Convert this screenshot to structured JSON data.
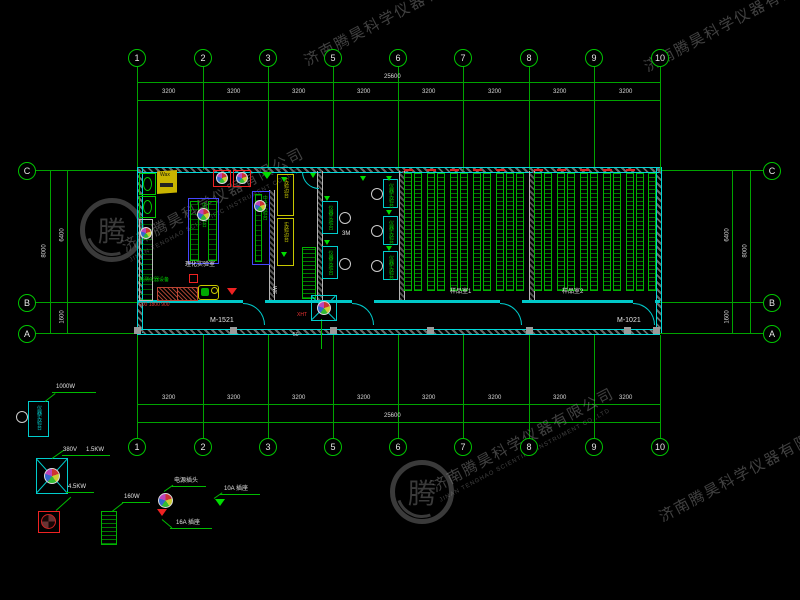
{
  "watermark": {
    "cn": "济南腾昊科学仪器有限公司",
    "en": "JINAN TENGHAO SCIENTIFIC INSTRUMENT CO.,LTD",
    "logo_char": "腾"
  },
  "grid": {
    "cols": [
      "1",
      "2",
      "3",
      "5",
      "6",
      "7",
      "8",
      "9",
      "10"
    ],
    "bay_dim": "3200",
    "total_dim": "25600",
    "rows": [
      "C",
      "B",
      "A"
    ],
    "row_dim_cb": "6400",
    "row_dim_ba": "1600",
    "row_dim_total": "8000"
  },
  "plan": {
    "door_left_label": "M-1521",
    "door_right_label": "M-1021",
    "room_lab_label": "理化实验室",
    "room_mid_label": "3M",
    "room_sample1_label": "样品室1",
    "room_sample2_label": "样品室2",
    "bench_center_text": "中央实验台",
    "bench_side_text": "实验边台",
    "bench_instrument_text": "仪器实验台",
    "fan_label": "XHT",
    "sink_label": "WS",
    "dim_small": "50",
    "red_dim_text": "900 1800 900",
    "green_note": "监测仪器设备",
    "cabinet_label": "Wax"
  },
  "legend": {
    "bench_text": "仪器实验台",
    "bench_power": "1000W",
    "fan_voltage": "380V",
    "fan_power": "1.5KW",
    "fan2_power": "4.5KW",
    "rack_power": "160W",
    "plug_label": "电源插头",
    "socket16_label": "16A 插座",
    "socket10_label": "10A 插座"
  },
  "colors": {
    "grid_green": "#00a400",
    "wall_cyan": "#00d8d8",
    "accent_red": "#ee2222",
    "accent_yellow": "#c8c800",
    "bench_blue": "#4646ff",
    "equip_green": "#00dd00"
  }
}
